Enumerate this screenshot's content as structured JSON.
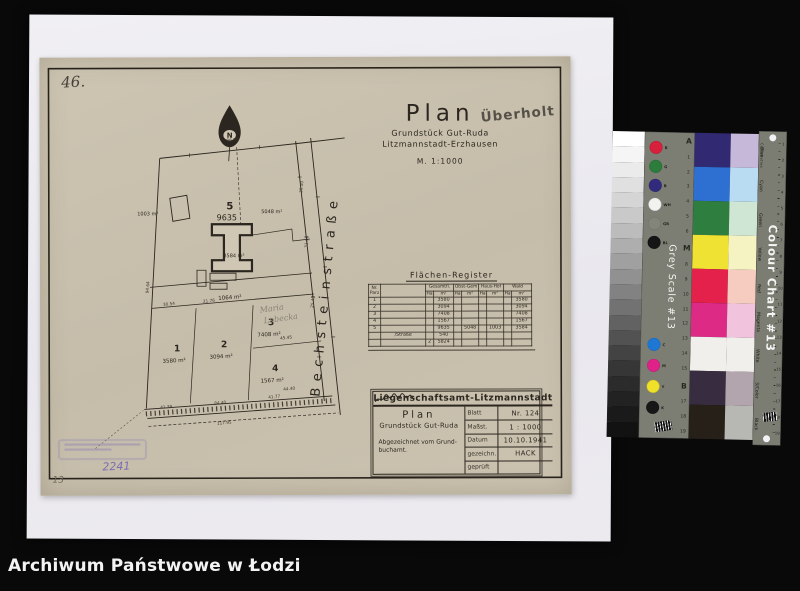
{
  "page": {
    "number": "46."
  },
  "title": {
    "main": "Plan",
    "overprint": "Überholt",
    "line1": "Grundstück Gut-Ruda",
    "line2": "Litzmannstadt-Erzhausen",
    "scale": "M. 1:1000"
  },
  "plan": {
    "north": "N",
    "street": "Bechsteinstraße",
    "strip_area": "1064 m²",
    "hand_owner1": "Maria",
    "hand_owner2": "Lubecka",
    "stamp_number": "2241",
    "corner_note": "13",
    "plots": {
      "p1": {
        "no": "1",
        "area": "3580 m²"
      },
      "p2": {
        "no": "2",
        "area": "3094 m²"
      },
      "p3": {
        "no": "3",
        "area": "7408 m²"
      },
      "p4": {
        "no": "4",
        "area": "1567 m²"
      },
      "p5": {
        "no": "5",
        "area": "9635",
        "left": "1003 m²",
        "right": "5048 m²",
        "yard": "3584 m²"
      }
    },
    "meas": {
      "top": "86.08",
      "left": "94.64",
      "s1": "30.50",
      "s2": "31.16",
      "s3": "25.43",
      "r1": "45.45",
      "r2": "44.40",
      "w1": "30.54",
      "w2": "21.76",
      "b1": "41.39",
      "b2": "84.40",
      "b3": "41.77",
      "b4": "117.95"
    }
  },
  "register": {
    "title": "Flächen-Register",
    "head": {
      "nr1": "Nr.",
      "nr2": "Parz",
      "gesamt": "Gesamtfl.",
      "obst": "Obst-Gem",
      "haus": "Haus-Hof",
      "wald": "Wald",
      "ha": "Ha",
      "m2": "m²"
    },
    "rows": [
      {
        "nr": "1",
        "name": "",
        "g_ha": "",
        "g_m2": "3580",
        "w_m2": "3580"
      },
      {
        "nr": "2",
        "name": "",
        "g_m2": "3094",
        "w_m2": "3094"
      },
      {
        "nr": "3",
        "name": "",
        "g_m2": "7408",
        "w_m2": "7408"
      },
      {
        "nr": "4",
        "name": "",
        "g_m2": "1567",
        "w_m2": "1567"
      },
      {
        "nr": "5",
        "name": "",
        "g_m2": "9635",
        "o_m2": "5048",
        "h_m2": "1003",
        "w_m2": "3584"
      },
      {
        "nr": "",
        "name": "/Straße",
        "g_m2": "540"
      },
      {
        "nr": "",
        "name": "",
        "g_ha": "2",
        "g_m2": "5824"
      }
    ]
  },
  "infobox": {
    "header": "Liegenschaftsamt-Litzmannstadt",
    "plan_title": "Plan",
    "subject": "Grundstück Gut-Ruda",
    "note1": "Abgezeichnet vom Grund-",
    "note2": "buchamt.",
    "rows": [
      {
        "label": "Blatt",
        "value": "Nr. 124"
      },
      {
        "label": "Maßst.",
        "value": "1 : 1000"
      },
      {
        "label": "Datum",
        "value": "10.10.1941"
      },
      {
        "label": "gezeichn.",
        "value": "HACK"
      },
      {
        "label": "geprüft",
        "value": ""
      }
    ]
  },
  "chart": {
    "grey_scale_title": "Grey Scale #13",
    "title": "Colour Chart #13",
    "centimetres": "Centimetres",
    "scale_marks": [
      "A",
      "1",
      "2",
      "3",
      "4",
      "5",
      "6",
      "M",
      "8",
      "9",
      "10",
      "11",
      "12",
      "13",
      "14",
      "15",
      "B",
      "17",
      "18",
      "19"
    ],
    "ruler_numbers": [
      "1",
      "2",
      "3",
      "4",
      "5",
      "6",
      "7",
      "8",
      "9",
      "10",
      "11",
      "12",
      "13",
      "14",
      "15",
      "16",
      "17",
      "18",
      "19"
    ],
    "dots_top": [
      {
        "label": "R",
        "color": "#d6203c"
      },
      {
        "label": "G",
        "color": "#2c7c3c"
      },
      {
        "label": "B",
        "color": "#322a7c"
      },
      {
        "label": "WH",
        "color": "#f2f2f0"
      },
      {
        "label": "GR",
        "color": "#83857b"
      },
      {
        "label": "BL",
        "color": "#151515"
      }
    ],
    "dots_bottom": [
      {
        "label": "C",
        "color": "#1f77d4"
      },
      {
        "label": "M",
        "color": "#df2288"
      },
      {
        "label": "Y",
        "color": "#efe02a"
      },
      {
        "label": "K",
        "color": "#171717"
      }
    ],
    "patches": [
      {
        "label": "Blue",
        "strong": "#312a72",
        "tint": "#c6b8d8"
      },
      {
        "label": "Cyan",
        "strong": "#2e70d2",
        "tint": "#badcf2"
      },
      {
        "label": "Green",
        "strong": "#2e7e40",
        "tint": "#d0e6d4"
      },
      {
        "label": "Yellow",
        "strong": "#f0e233",
        "tint": "#f6f3c2"
      },
      {
        "label": "Red",
        "strong": "#e3214a",
        "tint": "#f6ccc0"
      },
      {
        "label": "Magenta",
        "strong": "#dd2a85",
        "tint": "#f1c3dc"
      },
      {
        "label": "White",
        "strong": "#f1efec",
        "tint": "#f1efec"
      },
      {
        "label": "3/Color",
        "strong": "#382d40",
        "tint": "#b2a5ad"
      },
      {
        "label": "Black",
        "strong": "#262019",
        "tint": "#b7b8b4"
      }
    ],
    "grey_steps": [
      "#ffffff",
      "#f5f5f5",
      "#ebebeb",
      "#e0e0e0",
      "#d5d5d5",
      "#c9c9c9",
      "#bcbcbc",
      "#aeaeae",
      "#a0a0a0",
      "#919191",
      "#828282",
      "#727272",
      "#626262",
      "#525252",
      "#434343",
      "#363636",
      "#2b2b2b",
      "#222222",
      "#1a1a1a",
      "#121212"
    ]
  },
  "archive": {
    "caption": "Archiwum Państwowe w Łodzi"
  }
}
